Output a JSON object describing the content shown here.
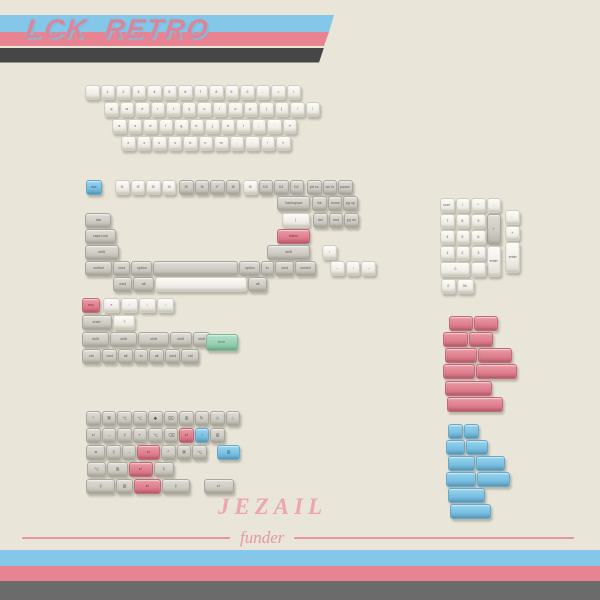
{
  "banner_top": {
    "title": "LCK RETRO",
    "title_color": "#db8698",
    "stripe_blue": "#84c7e8",
    "stripe_pink": "#e88492",
    "stripe_dark": "#464646"
  },
  "banner_bottom": {
    "stripe_blue": "#84c7e8",
    "stripe_pink": "#e88492",
    "stripe_dark": "#6b6b6b"
  },
  "branding": {
    "name": "JEZAIL",
    "tagline": "funder",
    "color": "#eba6b2",
    "line_color": "#e498a4"
  },
  "palette": {
    "background": "#e9e5d9",
    "key_white": "#f1efe8",
    "key_gray": "#ceccc4",
    "key_blue": "#7cc0e2",
    "key_pink": "#e0808f",
    "key_green": "#98d0b4"
  },
  "clusters": [
    {
      "id": "alphas",
      "rows": [
        {
          "x": 85,
          "y": 85,
          "keys": [
            {
              "t": "`"
            },
            {
              "t": "1"
            },
            {
              "t": "2"
            },
            {
              "t": "3"
            },
            {
              "t": "4"
            },
            {
              "t": "5"
            },
            {
              "t": "6"
            },
            {
              "t": "7"
            },
            {
              "t": "8"
            },
            {
              "t": "9"
            },
            {
              "t": "0"
            },
            {
              "t": "-"
            },
            {
              "t": "="
            },
            {
              "t": "\\"
            }
          ]
        },
        {
          "x": 104,
          "y": 102,
          "keys": [
            {
              "t": "q"
            },
            {
              "t": "w"
            },
            {
              "t": "e"
            },
            {
              "t": "r"
            },
            {
              "t": "t"
            },
            {
              "t": "y"
            },
            {
              "t": "u"
            },
            {
              "t": "i"
            },
            {
              "t": "o"
            },
            {
              "t": "p"
            },
            {
              "t": "["
            },
            {
              "t": "]"
            },
            {
              "t": "/"
            },
            {
              "t": "\\"
            }
          ]
        },
        {
          "x": 112,
          "y": 119,
          "keys": [
            {
              "t": "a"
            },
            {
              "t": "s"
            },
            {
              "t": "d"
            },
            {
              "t": "f"
            },
            {
              "t": "g"
            },
            {
              "t": "h"
            },
            {
              "t": "j"
            },
            {
              "t": "k"
            },
            {
              "t": "l"
            },
            {
              "t": ";"
            },
            {
              "t": "'"
            },
            {
              "t": "↵"
            }
          ]
        },
        {
          "x": 121,
          "y": 136,
          "keys": [
            {
              "t": "z"
            },
            {
              "t": "x"
            },
            {
              "t": "c"
            },
            {
              "t": "v"
            },
            {
              "t": "b"
            },
            {
              "t": "n"
            },
            {
              "t": "m"
            },
            {
              "t": ","
            },
            {
              "t": "."
            },
            {
              "t": "/"
            },
            {
              "t": "⇧"
            }
          ]
        }
      ]
    },
    {
      "id": "modifiers",
      "rows": [
        {
          "x": 86,
          "y": 180,
          "keys": [
            {
              "t": "esc",
              "c": "blue",
              "w": 16
            },
            {
              "g": 12
            },
            {
              "t": "f1"
            },
            {
              "t": "f2"
            },
            {
              "t": "f3"
            },
            {
              "t": "f4"
            },
            {
              "g": 2
            },
            {
              "t": "f5",
              "c": "gray"
            },
            {
              "t": "f6",
              "c": "gray"
            },
            {
              "t": "f7",
              "c": "gray"
            },
            {
              "t": "f8",
              "c": "gray"
            },
            {
              "g": 2
            },
            {
              "t": "f9"
            },
            {
              "t": "f10",
              "c": "gray"
            },
            {
              "t": "f11",
              "c": "gray"
            },
            {
              "t": "f12",
              "c": "gray"
            },
            {
              "g": 2
            },
            {
              "t": "prt sc",
              "c": "gray"
            },
            {
              "t": "scr lk",
              "c": "gray"
            },
            {
              "t": "pause",
              "c": "gray"
            }
          ]
        },
        {
          "x": 277,
          "y": 196,
          "keys": [
            {
              "t": "backspace",
              "c": "gray",
              "w": 33
            },
            {
              "g": 1
            },
            {
              "t": "ins",
              "c": "gray"
            },
            {
              "t": "home",
              "c": "gray"
            },
            {
              "t": "pg up",
              "c": "gray"
            }
          ]
        },
        {
          "x": 85,
          "y": 213,
          "keys": [
            {
              "t": "tab",
              "c": "gray",
              "w": 26
            },
            {
              "g": 170
            },
            {
              "t": "|",
              "w": 28
            },
            {
              "g": 2
            },
            {
              "t": "del",
              "c": "gray"
            },
            {
              "t": "end",
              "c": "gray"
            },
            {
              "t": "pg dn",
              "c": "gray"
            }
          ]
        },
        {
          "x": 85,
          "y": 229,
          "keys": [
            {
              "t": "caps lock",
              "c": "gray",
              "w": 31
            },
            {
              "g": 160
            },
            {
              "t": "return",
              "c": "pink",
              "w": 33
            }
          ]
        },
        {
          "x": 85,
          "y": 245,
          "keys": [
            {
              "t": "shift",
              "c": "gray",
              "w": 34
            },
            {
              "g": 147
            },
            {
              "t": "shift",
              "c": "gray",
              "w": 43
            },
            {
              "g": 11
            },
            {
              "t": "↑"
            }
          ]
        },
        {
          "x": 85,
          "y": 261,
          "c": "gray",
          "keys": [
            {
              "t": "control",
              "w": 27
            },
            {
              "t": "cmd",
              "w": 17
            },
            {
              "t": "option",
              "w": 21
            },
            {
              "t": "",
              "w": 85,
              "n": "spacebar"
            },
            {
              "t": "option",
              "w": 21
            },
            {
              "t": "fn",
              "w": 13
            },
            {
              "t": "cmd",
              "w": 19
            },
            {
              "t": "control",
              "w": 21
            },
            {
              "g": 13
            },
            {
              "t": "←",
              "c": "white"
            },
            {
              "t": "↓",
              "c": "white"
            },
            {
              "t": "→",
              "c": "white"
            }
          ]
        },
        {
          "x": 113,
          "y": 277,
          "c": "gray",
          "keys": [
            {
              "t": "cmd",
              "w": 19
            },
            {
              "t": "alt",
              "w": 21
            },
            {
              "t": "",
              "w": 92,
              "c": "white",
              "n": "spacebar"
            },
            {
              "t": "alt",
              "w": 19
            }
          ]
        }
      ]
    },
    {
      "id": "extras",
      "rows": [
        {
          "x": 82,
          "y": 298,
          "keys": [
            {
              "t": "esc",
              "c": "pink",
              "w": 18
            },
            {
              "g": 2
            },
            {
              "t": "♥",
              "w": 17,
              "fg": "#d8798b"
            },
            {
              "t": "☼",
              "w": 17,
              "fg": "#79b6d8"
            },
            {
              "t": "♪",
              "w": 17,
              "fg": "#d8798b"
            },
            {
              "t": "☺",
              "w": 17,
              "fg": "#79b6d8"
            }
          ]
        },
        {
          "x": 82,
          "y": 315,
          "c": "gray",
          "keys": [
            {
              "t": "enter",
              "w": 30
            },
            {
              "t": "?",
              "c": "white",
              "w": 22
            }
          ]
        },
        {
          "x": 82,
          "y": 332,
          "c": "gray",
          "keys": [
            {
              "t": "shift",
              "w": 27
            },
            {
              "t": "shift",
              "w": 27
            },
            {
              "t": "shift",
              "w": 31
            },
            {
              "t": "shift",
              "w": 22
            },
            {
              "t": "shift",
              "w": 17
            }
          ]
        },
        {
          "x": 82,
          "y": 349,
          "c": "gray",
          "keys": [
            {
              "t": "ctrl",
              "w": 19
            },
            {
              "t": "cmd",
              "w": 15
            },
            {
              "t": "alt",
              "w": 15
            },
            {
              "t": "fn",
              "w": 14
            },
            {
              "t": "alt",
              "w": 15
            },
            {
              "t": "cmd",
              "w": 15
            },
            {
              "t": "ctrl",
              "w": 18
            }
          ]
        },
        {
          "x": 206,
          "y": 334,
          "keys": [
            {
              "t": "love",
              "c": "green",
              "w": 32,
              "h": 17
            }
          ]
        }
      ]
    },
    {
      "id": "numpad",
      "rows": [
        {
          "x": 440,
          "y": 198,
          "keys": [
            {
              "t": "num"
            },
            {
              "t": "/"
            },
            {
              "t": "*"
            },
            {
              "t": "-"
            }
          ]
        },
        {
          "x": 440,
          "y": 214,
          "keys": [
            {
              "t": "7"
            },
            {
              "t": "8"
            },
            {
              "t": "9"
            },
            {
              "t": "+",
              "c": "gray",
              "h": 31
            }
          ]
        },
        {
          "x": 505,
          "y": 210,
          "keys": [
            {
              "t": "-"
            }
          ]
        },
        {
          "x": 440,
          "y": 230,
          "keys": [
            {
              "t": "4"
            },
            {
              "t": "5"
            },
            {
              "t": "6"
            }
          ]
        },
        {
          "x": 505,
          "y": 226,
          "keys": [
            {
              "t": "+"
            }
          ]
        },
        {
          "x": 440,
          "y": 246,
          "keys": [
            {
              "t": "1"
            },
            {
              "t": "2"
            },
            {
              "t": "3"
            },
            {
              "t": "enter",
              "h": 31
            }
          ]
        },
        {
          "x": 505,
          "y": 242,
          "keys": [
            {
              "t": "enter",
              "h": 31
            }
          ]
        },
        {
          "x": 440,
          "y": 262,
          "keys": [
            {
              "t": "0",
              "w": 30
            },
            {
              "t": "."
            }
          ]
        },
        {
          "x": 441,
          "y": 279,
          "keys": [
            {
              "t": "0"
            },
            {
              "t": "00",
              "w": 17
            }
          ]
        }
      ]
    },
    {
      "id": "pink-blanks",
      "c": "pink",
      "rows": [
        {
          "x": 449,
          "y": 316,
          "keys": [
            {
              "w": 24
            },
            {
              "w": 24
            }
          ]
        },
        {
          "x": 443,
          "y": 332,
          "keys": [
            {
              "w": 25
            },
            {
              "w": 24
            }
          ]
        },
        {
          "x": 445,
          "y": 348,
          "keys": [
            {
              "w": 32
            },
            {
              "w": 34
            }
          ]
        },
        {
          "x": 443,
          "y": 364,
          "keys": [
            {
              "w": 32
            },
            {
              "w": 41
            }
          ]
        },
        {
          "x": 445,
          "y": 381,
          "keys": [
            {
              "w": 47
            }
          ]
        },
        {
          "x": 447,
          "y": 397,
          "keys": [
            {
              "w": 56
            }
          ]
        }
      ]
    },
    {
      "id": "blue-blanks",
      "c": "blue",
      "rows": [
        {
          "x": 448,
          "y": 424,
          "keys": [
            {
              "w": 15
            },
            {
              "w": 15
            }
          ]
        },
        {
          "x": 446,
          "y": 440,
          "keys": [
            {
              "w": 19
            },
            {
              "w": 22
            }
          ]
        },
        {
          "x": 448,
          "y": 456,
          "keys": [
            {
              "w": 27
            },
            {
              "w": 29
            }
          ]
        },
        {
          "x": 446,
          "y": 472,
          "keys": [
            {
              "w": 30
            },
            {
              "w": 33
            }
          ]
        },
        {
          "x": 448,
          "y": 488,
          "keys": [
            {
              "w": 37
            }
          ]
        },
        {
          "x": 450,
          "y": 504,
          "keys": [
            {
              "w": 41
            }
          ]
        }
      ]
    },
    {
      "id": "icon-mods",
      "c": "gray",
      "fs": 6,
      "rows": [
        {
          "x": 86,
          "y": 411,
          "keys": [
            {
              "t": "^"
            },
            {
              "t": "⌘"
            },
            {
              "t": "⌥"
            },
            {
              "t": "⌥"
            },
            {
              "t": "◆"
            },
            {
              "t": "⌦"
            },
            {
              "t": "⊞"
            },
            {
              "t": "↻"
            },
            {
              "t": "◇"
            },
            {
              "t": "⌂"
            }
          ]
        },
        {
          "x": 86,
          "y": 428,
          "keys": [
            {
              "t": "↵"
            },
            {
              "t": "→"
            },
            {
              "t": "⇧"
            },
            {
              "t": "+"
            },
            {
              "t": "⌥"
            },
            {
              "t": "⌫"
            },
            {
              "t": "↵",
              "c": "pink"
            },
            {
              "t": "◔",
              "c": "blue"
            },
            {
              "t": "⊞"
            }
          ]
        },
        {
          "x": 86,
          "y": 445,
          "keys": [
            {
              "t": "≡",
              "w": 19
            },
            {
              "t": "⇧"
            },
            {
              "t": "→"
            },
            {
              "t": "↵",
              "c": "pink",
              "w": 23
            },
            {
              "t": "^"
            },
            {
              "t": "⌘"
            },
            {
              "t": "⌥"
            }
          ]
        },
        {
          "x": 217,
          "y": 445,
          "keys": [
            {
              "t": "⊞",
              "c": "blue",
              "w": 23
            }
          ]
        },
        {
          "x": 87,
          "y": 462,
          "keys": [
            {
              "t": "⌥",
              "w": 19
            },
            {
              "t": "⊞",
              "w": 21
            },
            {
              "t": "↵",
              "c": "pink",
              "w": 24
            },
            {
              "t": "⇧",
              "w": 20
            }
          ]
        },
        {
          "x": 86,
          "y": 479,
          "keys": [
            {
              "t": "⇪",
              "w": 29
            },
            {
              "t": "⊞",
              "w": 17
            },
            {
              "t": "↵",
              "c": "pink",
              "w": 27
            },
            {
              "t": "⇧",
              "w": 28
            },
            {
              "g": 13
            },
            {
              "t": "↵",
              "w": 30
            }
          ]
        }
      ]
    }
  ]
}
